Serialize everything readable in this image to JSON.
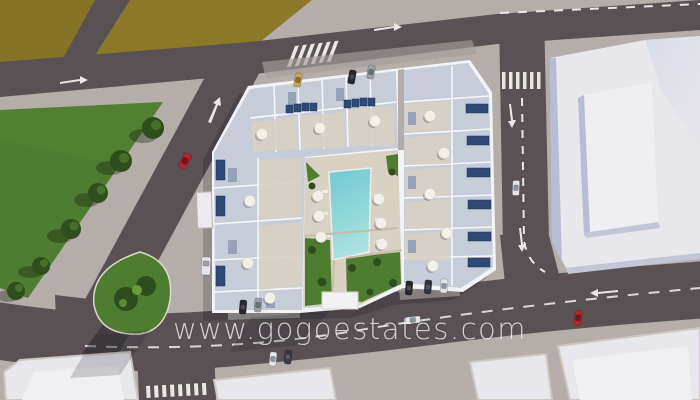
{
  "image": {
    "type": "aerial-3d-architectural-render",
    "subject": "Top-down 3D render of a new-build apartment complex with rooftop terraces, solar panels and a central courtyard swimming pool, surrounded by streets, a grass field and neighbouring white buildings",
    "brand": "gogoestates"
  },
  "watermark": {
    "text": "www.gogoestates.com",
    "color": "#ffffff",
    "opacity": 0.74
  },
  "palette": {
    "sidewalk": "#b5adaa",
    "road": "#595154",
    "road_dark": "#524b4e",
    "field": "#8b7929",
    "field_dark": "#7c6c22",
    "grass": "#4e7c31",
    "tree": "#2f4e1d",
    "tree_light": "#4c7a2a",
    "building_white": "#e8e7ec",
    "building_face_shade": "#b7bdd2",
    "complex_wall": "#f2f3f7",
    "complex_roof": "#c7cdd8",
    "terrace": "#d8d1c5",
    "courtyard": "#d9d1c4",
    "pool_deep": "#6fc9d3",
    "pool_shallow": "#ace1e1",
    "solar_panel": "#2f4a76",
    "stair_core": "#97a2b8",
    "umbrella": "#f3f0e9",
    "marking": "#e9e7e3",
    "car_red": "#b3262c",
    "car_tan": "#c8a552",
    "car_dark": "#26262e",
    "car_gray": "#9aa0a8",
    "car_white": "#e4e6ea",
    "shadow": "rgba(22,22,32,0.22)"
  },
  "scene_inventory": {
    "roads": [
      "top-road",
      "top-left-side-road",
      "left-diagonal-road",
      "right-vertical-road",
      "bottom-road",
      "bottom-side-street"
    ],
    "crosswalks": 3,
    "green_areas": [
      "grass-field-triangle",
      "palm-island",
      "olive-field"
    ],
    "trees": 6,
    "palm_trees": 2,
    "cars": 14,
    "pool": "central turquoise swimming pool with sun loungers and parasols",
    "umbrellas": 17,
    "neighbour_buildings": [
      "large-white-building-top-right",
      "rooftop-bottom-right",
      "rooftop-bottom-left-a",
      "rooftop-bottom-left-b"
    ]
  }
}
